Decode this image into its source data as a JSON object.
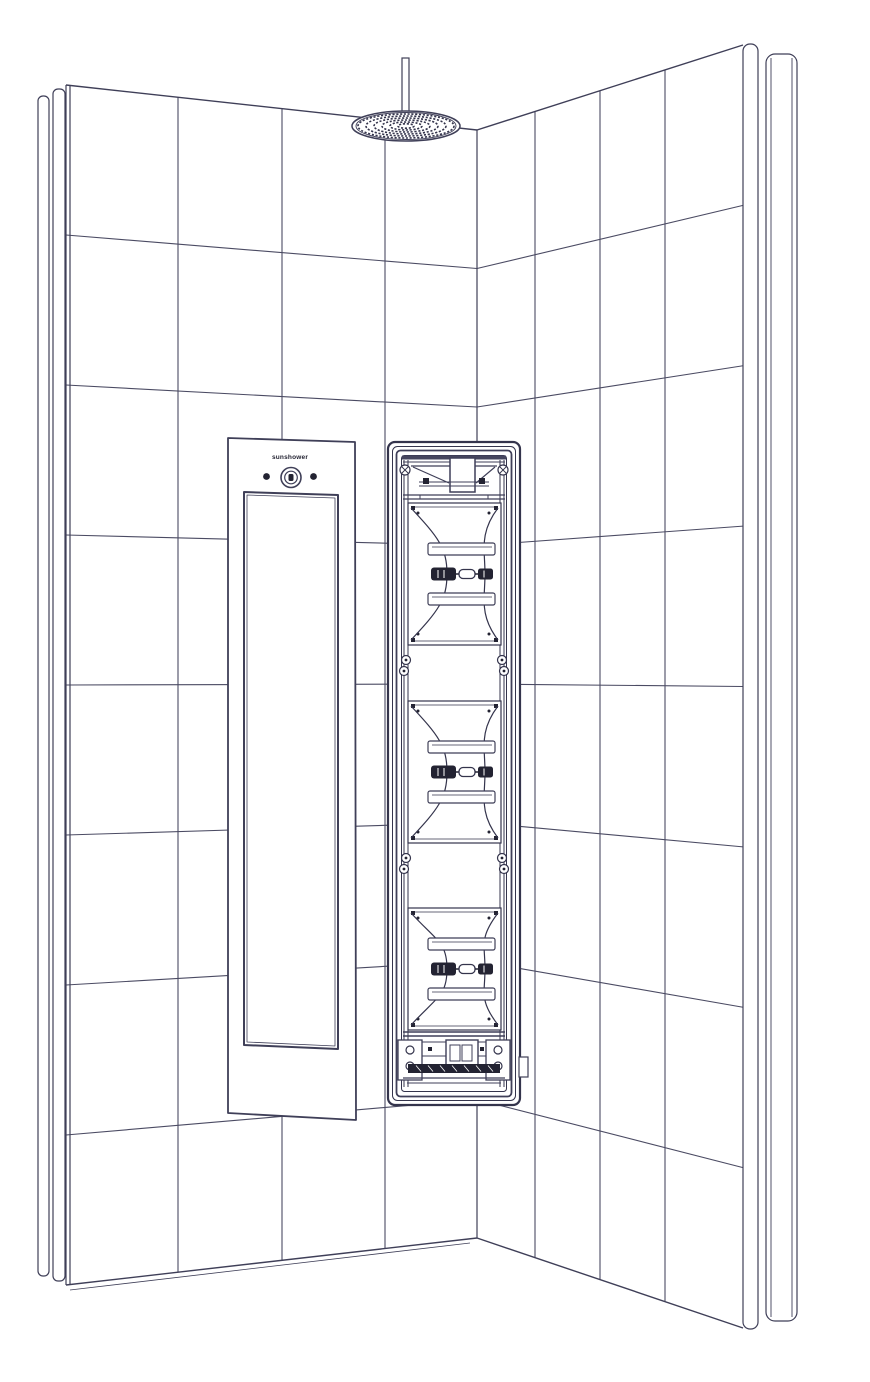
{
  "canvas": {
    "w": 870,
    "h": 1382,
    "bg": "#ffffff"
  },
  "palette": {
    "line": "#3f3f58",
    "grout": "#4b4b63",
    "detail": "#34344c",
    "dark": "#232332",
    "band": "#45455e",
    "white": "#ffffff"
  },
  "walls": {
    "rows": 8,
    "corner_x": 477,
    "left": {
      "top": [
        [
          66,
          85
        ],
        [
          477,
          130
        ]
      ],
      "bottom": [
        [
          66,
          1285
        ],
        [
          477,
          1238
        ]
      ],
      "verticals": [
        178,
        282,
        385
      ]
    },
    "right": {
      "top": [
        [
          477,
          130
        ],
        [
          743,
          45
        ]
      ],
      "bottom": [
        [
          477,
          1238
        ],
        [
          743,
          1328
        ]
      ],
      "verticals": [
        535,
        600,
        665
      ]
    },
    "left_edge_strips": [
      {
        "x": 38,
        "y": 96,
        "w": 11,
        "h": 1180
      },
      {
        "x": 53,
        "y": 89,
        "w": 12,
        "h": 1192
      }
    ],
    "left_edge_lines": [
      66,
      70
    ],
    "right_edge": {
      "x": 743,
      "y": 44,
      "w": 15,
      "h": 1285
    },
    "back_strip": {
      "x": 766,
      "y": 54,
      "w": 31,
      "h": 1267,
      "inner_lines": [
        771,
        792
      ]
    }
  },
  "shower_head": {
    "pipe": {
      "x": 402,
      "y": 58,
      "w": 7,
      "h": 62
    },
    "head": {
      "cx": 406,
      "cy": 126,
      "rx": 54,
      "ry": 15
    },
    "nozzle_rings": [
      [
        48,
        12
      ],
      [
        40,
        10
      ],
      [
        32,
        8
      ],
      [
        24,
        6
      ],
      [
        16,
        4
      ],
      [
        8,
        2.2
      ]
    ]
  },
  "left_panel": {
    "outer": [
      [
        228,
        438
      ],
      [
        355,
        442
      ],
      [
        356,
        1120
      ],
      [
        228,
        1113
      ]
    ],
    "inner": [
      [
        244,
        492
      ],
      [
        338,
        495
      ],
      [
        338,
        1049
      ],
      [
        244,
        1045
      ]
    ],
    "inner2": [
      [
        247,
        495
      ],
      [
        335,
        498
      ],
      [
        335,
        1046
      ],
      [
        247,
        1042
      ]
    ],
    "logo_text": "sunshower",
    "logo_pos": [
      290,
      459
    ],
    "dot_left": [
      266.5,
      476.5,
      3.4
    ],
    "dot_right": [
      313.5,
      476.5,
      3.4
    ],
    "button": {
      "cx": 291,
      "cy": 477.5,
      "r_outer": 10,
      "r_inner": 6.3
    }
  },
  "unit": {
    "frames": [
      {
        "x": 388,
        "y": 442,
        "w": 132,
        "h": 663,
        "r": 7,
        "sw": 2.2
      },
      {
        "x": 392.5,
        "y": 446.5,
        "w": 123,
        "h": 654,
        "r": 5,
        "sw": 1
      },
      {
        "x": 396.5,
        "y": 450.5,
        "w": 115,
        "h": 646,
        "r": 4,
        "sw": 1.8
      },
      {
        "x": 401.5,
        "y": 455.5,
        "w": 105,
        "h": 636,
        "r": 3,
        "sw": 1
      }
    ],
    "interior": {
      "x1": 403,
      "x2": 505,
      "y1": 456,
      "y2": 1091
    },
    "rail_xs": [
      404,
      408,
      500,
      504
    ],
    "top_band": {
      "x": 402,
      "y": 455.5,
      "w": 104,
      "h": 4
    },
    "modules": [
      {
        "top": 503,
        "bottom": 645
      },
      {
        "top": 701,
        "bottom": 843
      },
      {
        "top": 908,
        "bottom": 1030
      }
    ],
    "gap_screws": [
      [
        406,
        660
      ],
      [
        404,
        671
      ],
      [
        502,
        660
      ],
      [
        504,
        671
      ],
      [
        406,
        858
      ],
      [
        404,
        869
      ],
      [
        502,
        858
      ],
      [
        504,
        869
      ]
    ],
    "top_assembly": {
      "box": {
        "x": 450,
        "y": 458,
        "w": 25,
        "h": 34
      },
      "screws": [
        [
          405,
          470
        ],
        [
          503,
          470
        ]
      ],
      "squares": [
        [
          423,
          478
        ],
        [
          479,
          478
        ]
      ],
      "rail_y": [
        495,
        499
      ]
    },
    "bottom_assembly": {
      "rail_y": [
        1032,
        1036
      ],
      "plates": [
        {
          "x": 398,
          "y": 1040,
          "w": 24,
          "h": 40
        },
        {
          "x": 486,
          "y": 1040,
          "w": 24,
          "h": 40
        }
      ],
      "box": {
        "x": 446,
        "y": 1040,
        "w": 32,
        "h": 26
      },
      "inner_boxes": [
        {
          "x": 450,
          "y": 1045,
          "w": 10,
          "h": 16
        },
        {
          "x": 462,
          "y": 1045,
          "w": 10,
          "h": 16
        }
      ],
      "dots": [
        [
          428,
          1047
        ],
        [
          480,
          1047
        ]
      ],
      "dark_bar": {
        "x": 408,
        "y": 1064,
        "w": 92,
        "h": 9
      },
      "tab": {
        "x": 519,
        "y": 1057,
        "w": 9,
        "h": 20
      }
    }
  }
}
